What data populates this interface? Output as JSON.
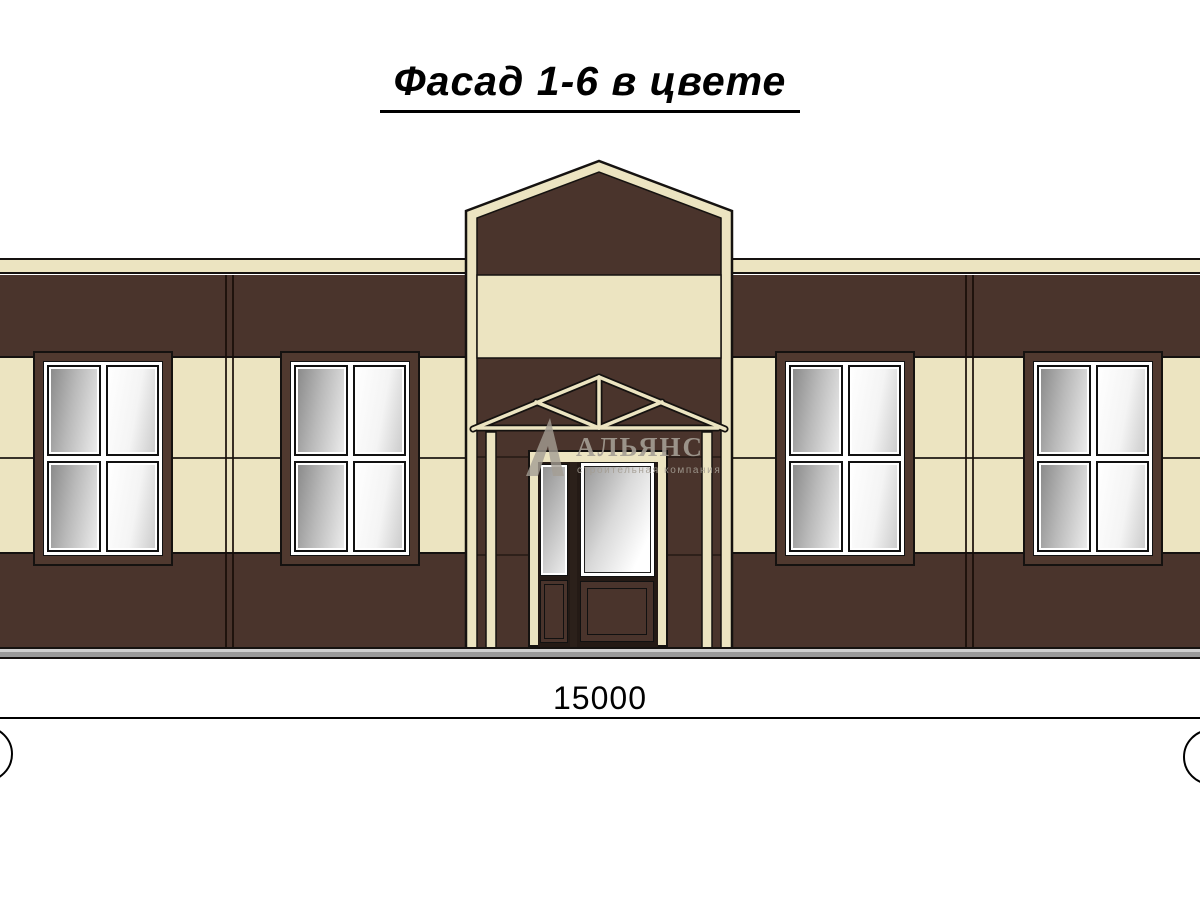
{
  "drawing": {
    "title": "Фасад 1-6 в цвете",
    "dimension_label": "15000"
  },
  "watermark": {
    "name": "АЛЬЯНС",
    "tagline": "строительная компания"
  },
  "colors": {
    "wall": "#4a342c",
    "cream": "#ece4c1",
    "casing": "#50392f",
    "plinth": "#9a9a9a",
    "plinth-light": "#cfcfcf",
    "outline": "#151210",
    "wm": "rgba(164,157,148,0.9)"
  },
  "facade": {
    "windows": [
      {
        "id": "window-1",
        "x": 33
      },
      {
        "id": "window-2",
        "x": 280
      },
      {
        "id": "window-3",
        "x": 775
      },
      {
        "id": "window-4",
        "x": 1023
      }
    ],
    "panel_joints_x": [
      225,
      965
    ]
  }
}
